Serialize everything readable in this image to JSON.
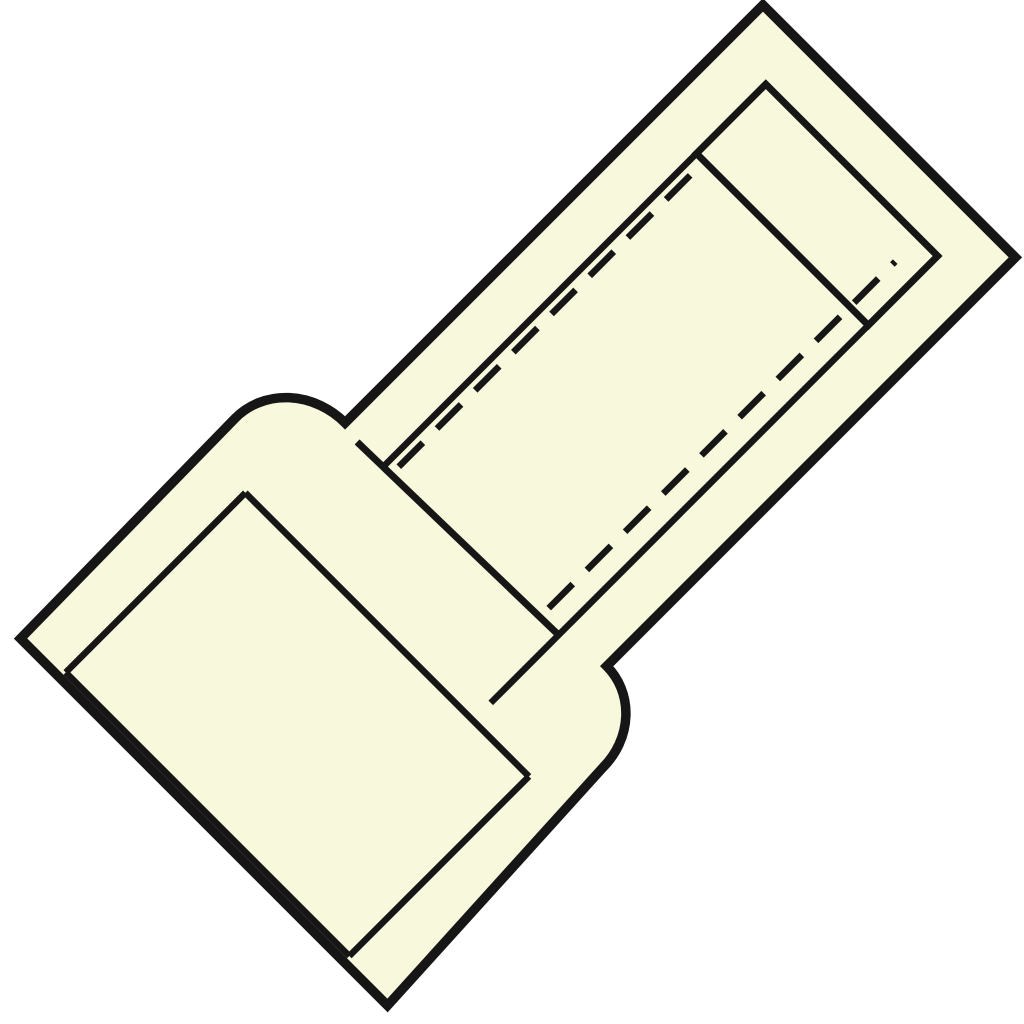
{
  "canvas": {
    "width": 1024,
    "height": 1024,
    "background": "#ffffff"
  },
  "colors": {
    "fill": "#f8f8dc",
    "stroke": "#161616",
    "background": "#ffffff"
  },
  "diagram": {
    "label": "insulated-crimp-connector-technical-drawing",
    "rotation_matrix": [
      0.70711,
      -0.70711,
      0.70711,
      0.70711,
      0,
      0
    ],
    "shapes": [
      {
        "name": "connector-outline",
        "type": "path",
        "fill": "fill",
        "stroke": "stroke",
        "stroke_width": 9.5,
        "d": "M 536 543 L 536 900 L -42 900 A 74 69 0 0 1 -116 969 L -437 985 L -437 466 L -129 462 A 74 81 0 0 1 -55 543 Z"
      },
      {
        "name": "tube-tip-band",
        "type": "path",
        "fill": "none",
        "stroke": "stroke",
        "stroke_width": 7,
        "d": "M 384 601 L 482 601 L 482 844 L 384 844 Z"
      },
      {
        "name": "tube-inner-wall-upper",
        "type": "line",
        "stroke": "stroke",
        "stroke_width": 6.5,
        "x1": 384,
        "y1": 601,
        "x2": -59,
        "y2": 601
      },
      {
        "name": "tube-inner-wall-lower",
        "type": "line",
        "stroke": "stroke",
        "stroke_width": 6.5,
        "x1": 384,
        "y1": 844,
        "x2": -150,
        "y2": 844
      },
      {
        "name": "collar-face-line",
        "type": "line",
        "stroke": "stroke",
        "stroke_width": 7,
        "x1": -60,
        "y1": 565,
        "x2": -54,
        "y2": 844
      },
      {
        "name": "sleeve-mouth-rim-line",
        "type": "line",
        "stroke": "stroke",
        "stroke_width": 6.5,
        "x1": -175,
        "y1": 522,
        "x2": -175,
        "y2": 923
      },
      {
        "name": "sleeve-inner-wall-upper",
        "type": "line",
        "stroke": "stroke",
        "stroke_width": 6.5,
        "x1": -175,
        "y1": 522,
        "x2": -429,
        "y2": 522
      },
      {
        "name": "sleeve-inner-wall-lower",
        "type": "line",
        "stroke": "stroke",
        "stroke_width": 6.5,
        "x1": -175,
        "y1": 923,
        "x2": -429,
        "y2": 923
      },
      {
        "name": "sleeve-inner-end-line",
        "type": "line",
        "stroke": "stroke",
        "stroke_width": 6.5,
        "x1": -429,
        "y1": 522,
        "x2": -429,
        "y2": 923
      },
      {
        "name": "hidden-edge-dashed-upper",
        "type": "line",
        "stroke": "stroke",
        "stroke_width": 6.5,
        "dash": "34 20",
        "x1": -48,
        "y1": 612,
        "x2": 370,
        "y2": 612
      },
      {
        "name": "hidden-edge-dashed-lower",
        "type": "line",
        "stroke": "stroke",
        "stroke_width": 6.5,
        "dash": "34 20",
        "x1": -42,
        "y1": 818,
        "x2": 448,
        "y2": 818
      }
    ]
  }
}
